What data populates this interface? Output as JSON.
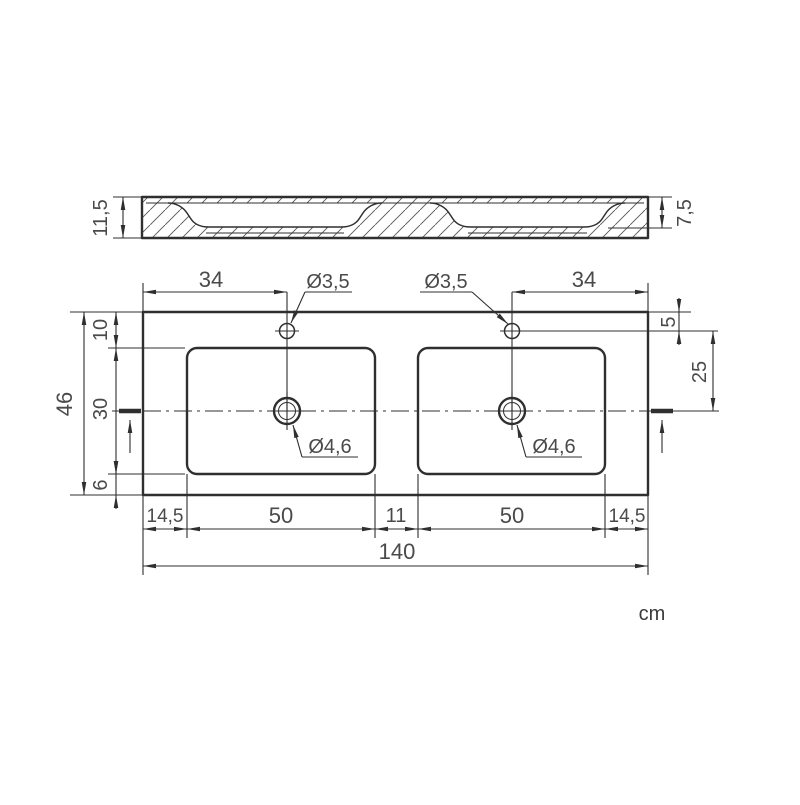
{
  "colors": {
    "ink": "#2f2f2f",
    "dim_text": "#4a4a4a",
    "background": "#ffffff"
  },
  "units_label": "cm",
  "section_view": {
    "overall_height": "11,5",
    "basin_depth": "7,5"
  },
  "plan_view": {
    "faucet_left_offset": "34",
    "faucet_left_dia": "Ø3,5",
    "faucet_right_dia": "Ø3,5",
    "faucet_right_offset": "34",
    "faucet_from_top": "5",
    "faucet_to_center": "25",
    "overall_height": "46",
    "top_to_basin": "10",
    "basin_height": "30",
    "basin_to_bottom": "6",
    "drain_left_dia": "Ø4,6",
    "drain_right_dia": "Ø4,6",
    "bottom_row": [
      "14,5",
      "50",
      "11",
      "50",
      "14,5"
    ],
    "overall_width": "140"
  }
}
